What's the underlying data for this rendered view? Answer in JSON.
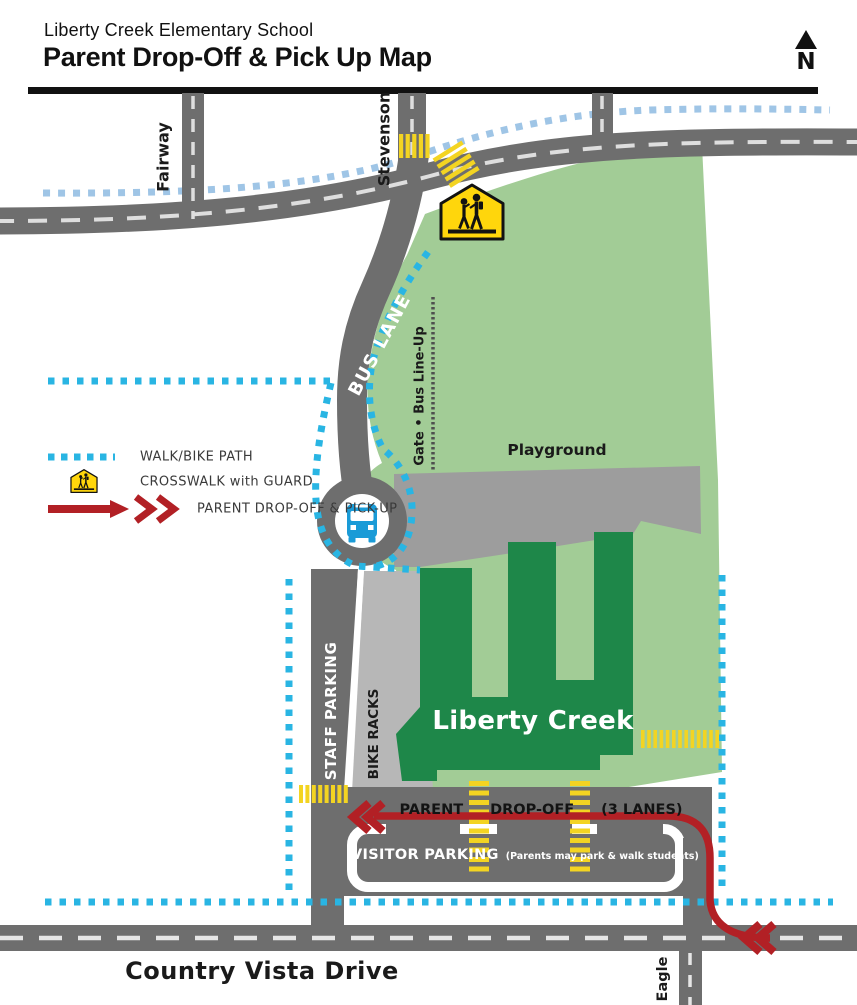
{
  "header": {
    "school_name": "Liberty Creek Elementary School",
    "title": "Parent Drop-Off & Pick Up Map",
    "north_label": "N"
  },
  "legend": {
    "items": [
      {
        "icon": "walk-bike-path-dotted-line",
        "label": "WALK/BIKE PATH"
      },
      {
        "icon": "school-crossing-sign",
        "label": "CROSSWALK with GUARD"
      },
      {
        "icon": "red-route-arrow",
        "label": "PARENT DROP-OFF & PICK-UP"
      }
    ]
  },
  "map": {
    "streets": {
      "fairway": "Fairway",
      "stevenson": "Stevenson",
      "country_vista": "Country Vista Drive",
      "eagle": "Eagle"
    },
    "labels": {
      "bus_lane": "BUS LANE",
      "gate_bus_lineup": "Gate • Bus Line-Up",
      "playground": "Playground",
      "school_building": "Liberty Creek",
      "staff_parking": "STAFF PARKING",
      "bike_racks": "BIKE RACKS",
      "parent_dropoff_words": [
        "PARENT",
        "DROP-OFF",
        "(3 LANES)"
      ],
      "visitor_parking": "VISITOR PARKING",
      "visitor_parking_note": "(Parents may park & walk students)"
    },
    "colors": {
      "road_gray": "#6e6e6e",
      "playground_gray": "#9d9d9d",
      "bike_racks_gray": "#b7b7b7",
      "field_green": "#a2cc96",
      "building_green": "#1e8749",
      "walk_path_cyan": "#29b5e3",
      "walk_path_blue": "#9fc5e6",
      "crosswalk_yellow": "#f3d422",
      "sign_yellow": "#ffd60c",
      "route_red": "#b22025",
      "bus_blue": "#1a9bd7"
    }
  }
}
